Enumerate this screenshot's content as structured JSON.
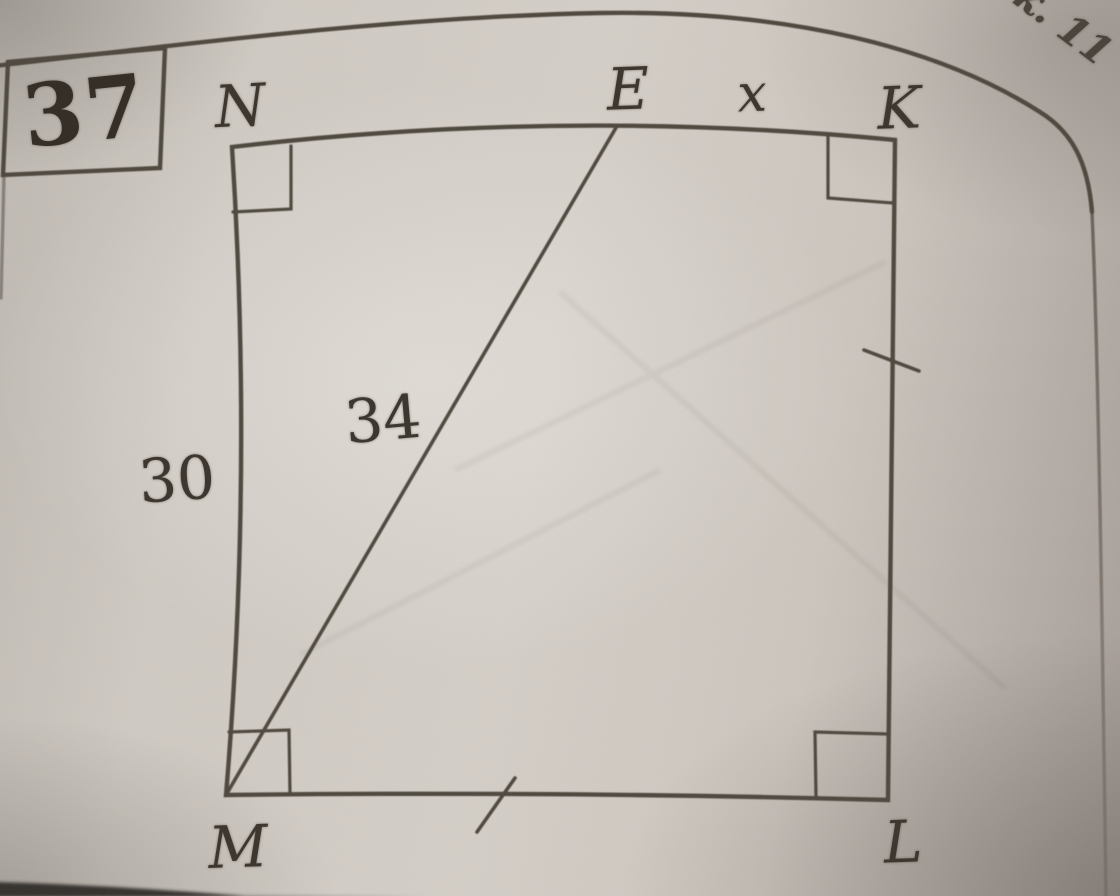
{
  "problem_number": "37",
  "figure": {
    "vertices": {
      "n": "N",
      "e": "E",
      "k": "K",
      "m": "M",
      "l": "L"
    },
    "measurements": {
      "side_nm": "30",
      "segment_me": "34",
      "segment_ek": "x"
    }
  },
  "page": {
    "corner_fragment": "ок. 11"
  },
  "colors": {
    "ink": "#4b443b",
    "paper_light": "#d4cec7",
    "paper_dark": "#a49b95",
    "shadow": "#332e29"
  }
}
